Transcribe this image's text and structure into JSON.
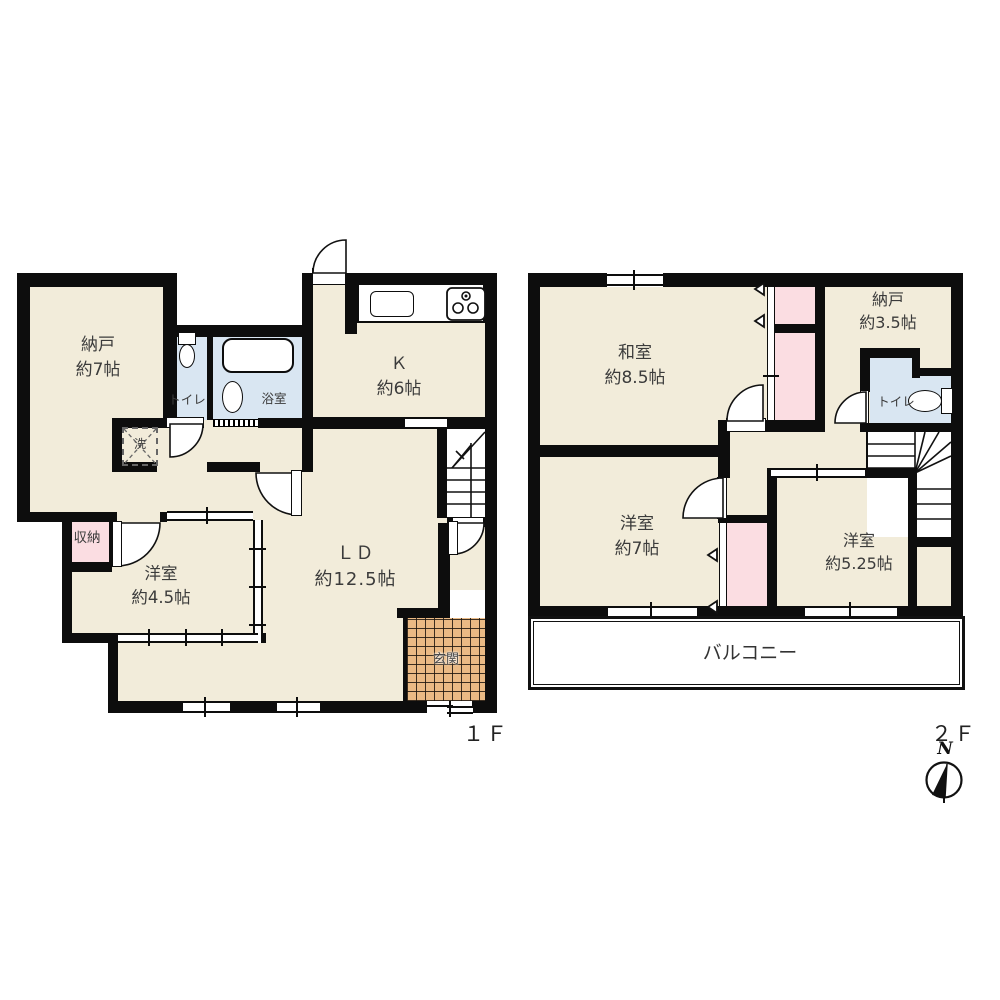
{
  "floor1": {
    "label": "１Ｆ",
    "rooms": {
      "nando": {
        "name": "納戸",
        "size": "約7帖"
      },
      "toilet": {
        "name": "トイレ"
      },
      "bath": {
        "name": "浴室"
      },
      "laundry": {
        "name": "洗"
      },
      "kitchen": {
        "name": "Ｋ",
        "size": "約6帖"
      },
      "living": {
        "name": "ＬＤ",
        "size": "約12.5帖"
      },
      "closet": {
        "name": "収納"
      },
      "western": {
        "name": "洋室",
        "size": "約4.5帖"
      },
      "entrance": {
        "name": "玄関"
      }
    }
  },
  "floor2": {
    "label": "２Ｆ",
    "rooms": {
      "japanese": {
        "name": "和室",
        "size": "約8.5帖"
      },
      "nando": {
        "name": "納戸",
        "size": "約3.5帖"
      },
      "toilet": {
        "name": "トイレ"
      },
      "western7": {
        "name": "洋室",
        "size": "約7帖"
      },
      "western525": {
        "name": "洋室",
        "size": "約5.25帖"
      },
      "balcony": {
        "name": "バルコニー"
      }
    }
  },
  "compass": {
    "north": "N"
  },
  "colors": {
    "floor": "#F2ECDA",
    "wet": "#D9E6F2",
    "closet": "#FBDDE2",
    "tile": "#EABA85",
    "wall": "#0d0d0d"
  }
}
